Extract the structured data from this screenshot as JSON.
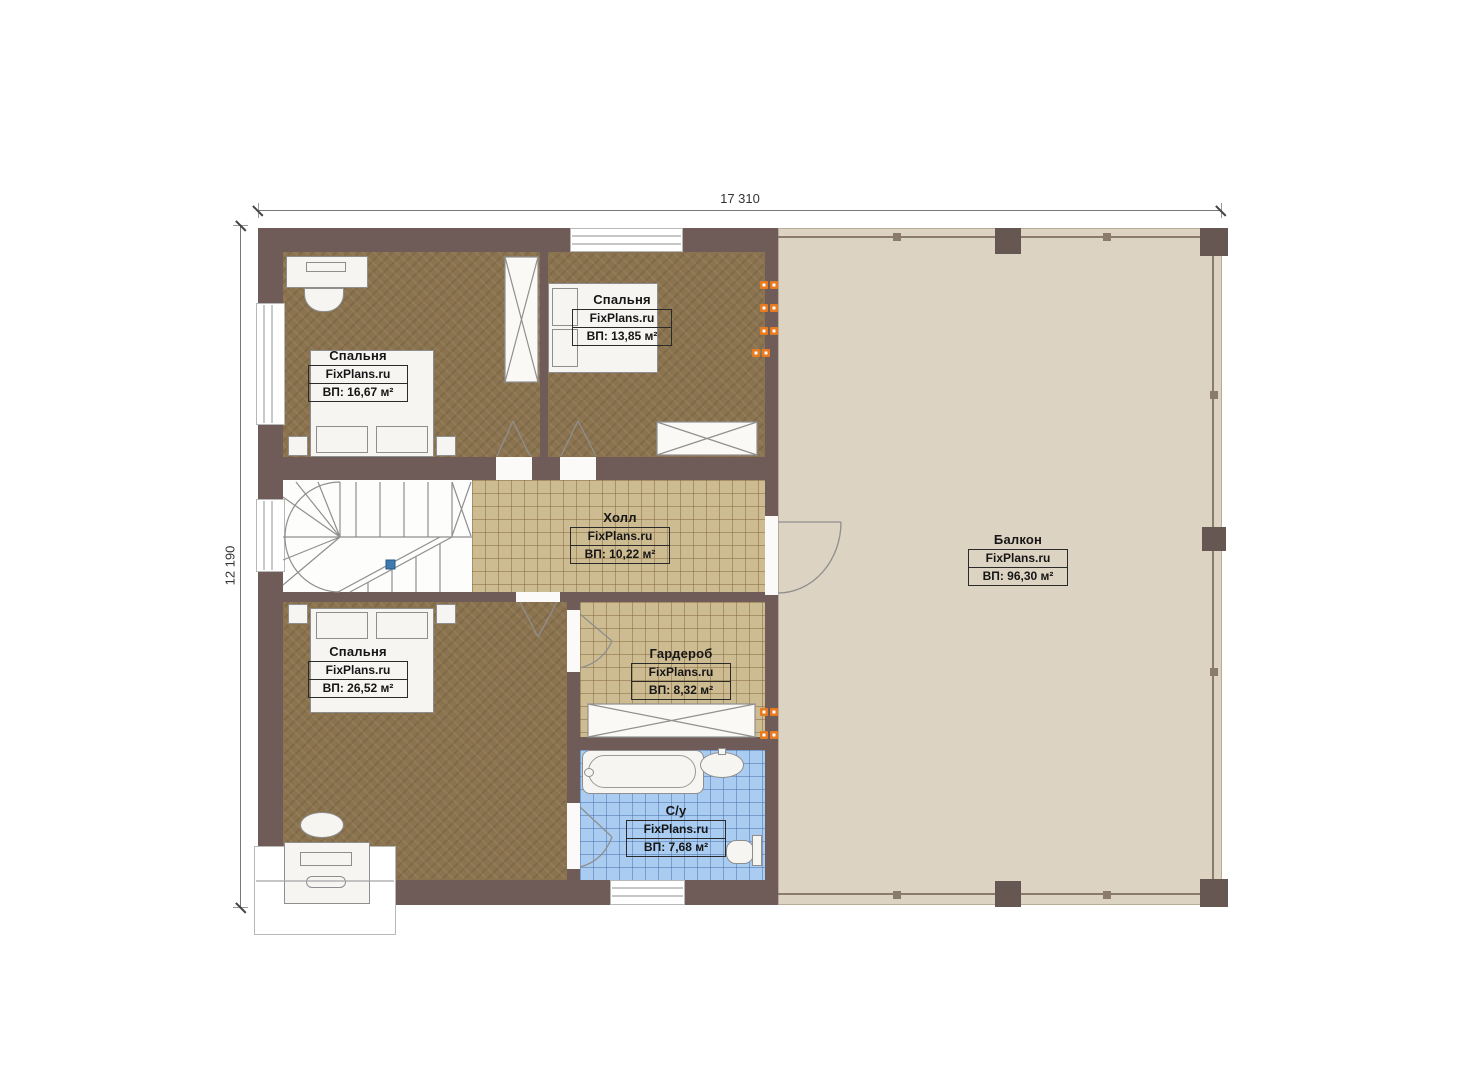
{
  "dimensions": {
    "width_label": "17 310",
    "height_label": "12 190"
  },
  "rooms": [
    {
      "id": "bedroom-top-left",
      "name": "Спальня",
      "brand": "FixPlans.ru",
      "area": "ВП: 16,67 м²"
    },
    {
      "id": "bedroom-top-middle",
      "name": "Спальня",
      "brand": "FixPlans.ru",
      "area": "ВП: 13,85 м²"
    },
    {
      "id": "hall",
      "name": "Холл",
      "brand": "FixPlans.ru",
      "area": "ВП: 10,22 м²"
    },
    {
      "id": "balcony",
      "name": "Балкон",
      "brand": "FixPlans.ru",
      "area": "ВП: 96,30 м²"
    },
    {
      "id": "bedroom-bottom-left",
      "name": "Спальня",
      "brand": "FixPlans.ru",
      "area": "ВП: 26,52 м²"
    },
    {
      "id": "wardrobe",
      "name": "Гардероб",
      "brand": "FixPlans.ru",
      "area": "ВП: 8,32 м²"
    },
    {
      "id": "bathroom",
      "name": "С/у",
      "brand": "FixPlans.ru",
      "area": "ВП: 7,68 м²"
    }
  ],
  "colors": {
    "wall": "#6f5b57",
    "bedroom_floor": "#8a734e",
    "tile_floor": "#cdbb92",
    "bath_tile": "#a9ccf0",
    "balcony_floor": "#ddd3c2",
    "radiator": "#e87a20",
    "stair_marker": "#3c7ab0"
  }
}
